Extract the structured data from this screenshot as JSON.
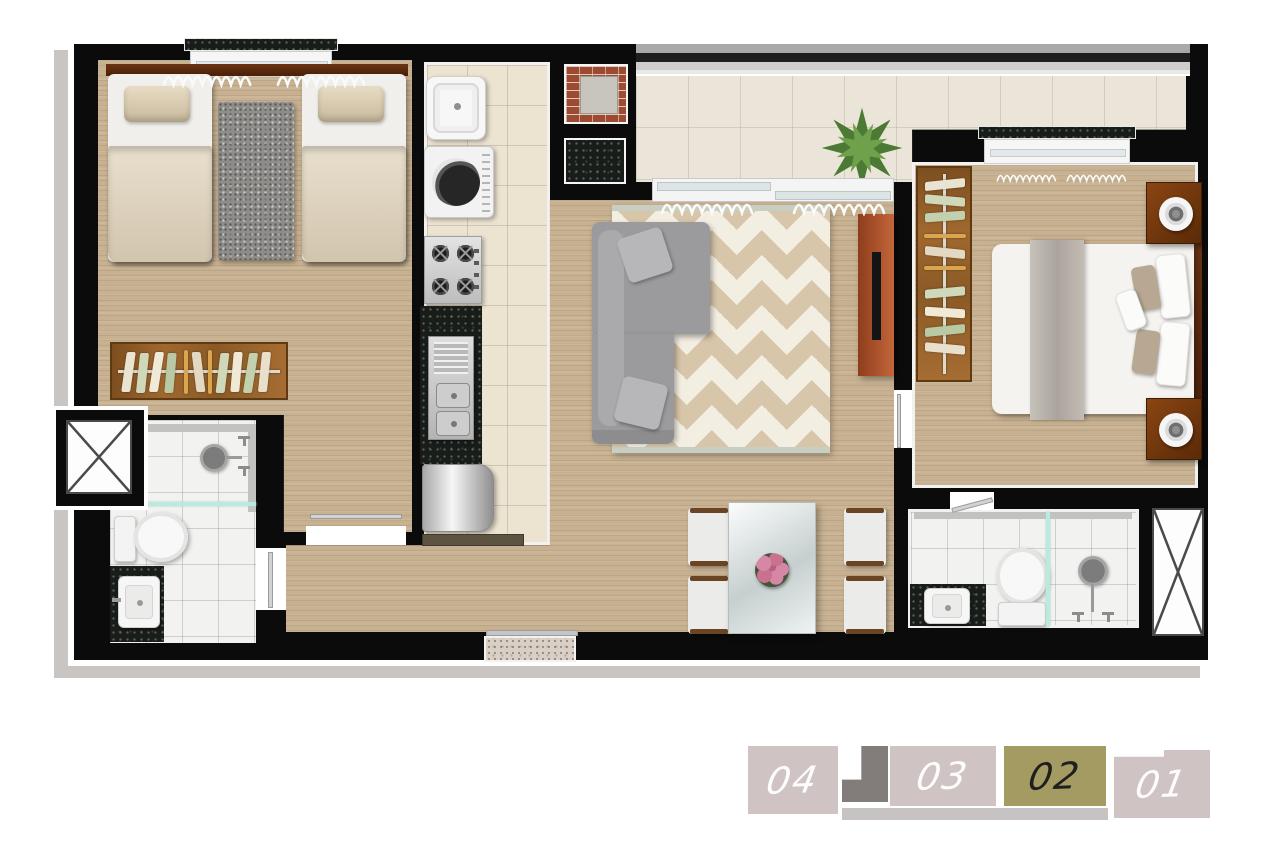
{
  "floor_plan": {
    "type": "apartment-floor-plan-top-view",
    "rooms": [
      "twin-bedroom",
      "bathroom-1",
      "kitchen-laundry",
      "living-dining",
      "balcony-terrace",
      "master-bedroom",
      "bathroom-2",
      "entry"
    ],
    "furniture": [
      "twin-beds",
      "shag-rug",
      "open-wardrobes",
      "utility-sink",
      "washing-machine",
      "cooktop",
      "kitchen-sink-counter",
      "refrigerator",
      "sectional-sofa",
      "chevron-rug",
      "tv-panel",
      "dining-table-4-chairs",
      "flower-centerpiece",
      "double-bed",
      "nightstands-with-lamps",
      "toilets",
      "washbasins",
      "showers",
      "bbq-brick-grill",
      "granite-counter",
      "planter-plant",
      "ventilation-shafts",
      "windows-with-curtains",
      "sliding-balcony-door",
      "entrance-threshold"
    ],
    "colors": {
      "wall": "#0b0b0b",
      "outline": "#ffffff",
      "shadow": "#c9c5c2",
      "wood_floor": "#c7b191",
      "kitchen_tile": "#ece3d1",
      "balcony_tile": "#eae5d8",
      "bathroom_tile": "#f2f2f0",
      "chevron_beige": "#d8c6aa",
      "chevron_cream": "#f3eee2",
      "sofa_gray": "#9b9a9c",
      "tv_panel_terracotta": "#b05a33",
      "wardrobe_wood": "#8a5a26",
      "nightstand_wood": "#7a3a1d",
      "granite_dark": "#191d19",
      "granite_light": "#d9d0c5",
      "glass_teal": "#bfe8dd",
      "brick": "#9c4a32",
      "plant_green": "#4c7a35"
    }
  },
  "unit_selector": {
    "units": [
      {
        "label": "04",
        "selected": false
      },
      {
        "label": "03",
        "selected": false
      },
      {
        "label": "02",
        "selected": true
      },
      {
        "label": "01",
        "selected": false
      }
    ],
    "selected_unit_label": "02",
    "colors": {
      "tab_bg": "#d0c3c3",
      "tab_selected_bg": "#a49b63",
      "tab_text": "#ffffff",
      "tab_selected_text": "#1f1f1f",
      "stairs_icon": "#827c7b",
      "underline_bar": "#c7c3c2"
    }
  }
}
